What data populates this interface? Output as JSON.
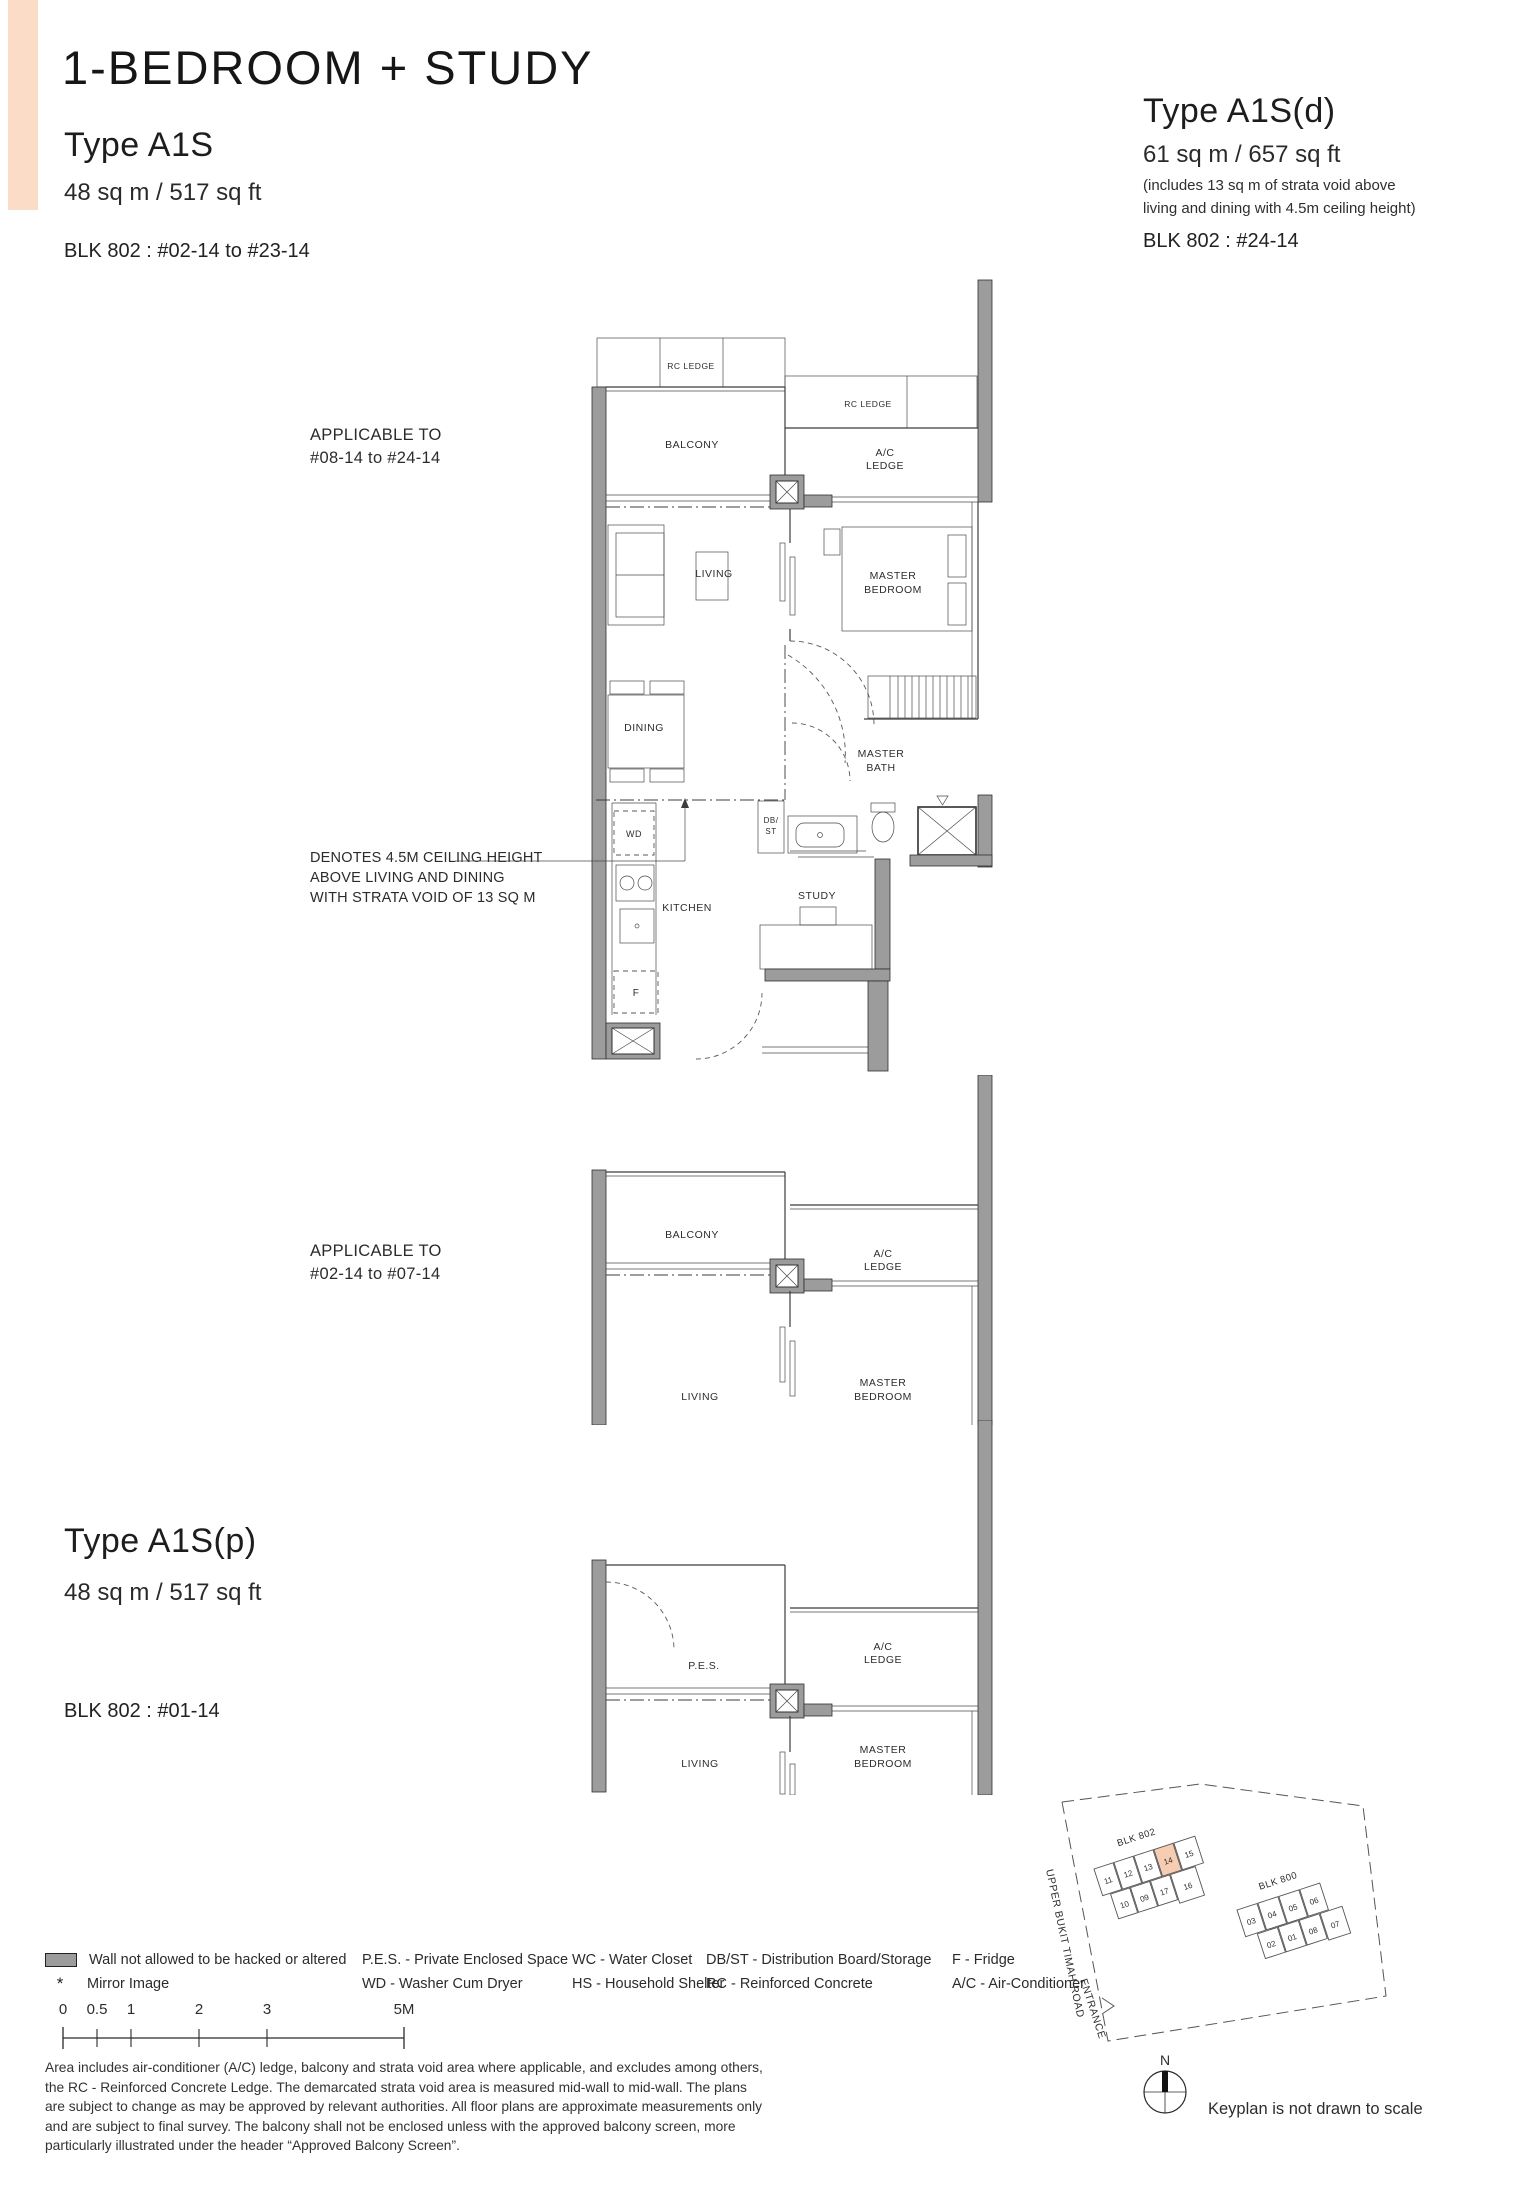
{
  "header": {
    "title": "1-BEDROOM + STUDY"
  },
  "types": {
    "a1s": {
      "name": "Type A1S",
      "area": "48 sq m / 517 sq ft",
      "block": "BLK 802 : #02-14 to #23-14"
    },
    "a1s_d": {
      "name": "Type A1S(d)",
      "area": "61 sq m / 657 sq ft",
      "area_note_line1": "(includes 13 sq m of strata void above",
      "area_note_line2": "living and dining with 4.5m ceiling height)",
      "block": "BLK 802 : #24-14"
    },
    "a1s_p": {
      "name": "Type A1S(p)",
      "area": "48 sq m / 517 sq ft",
      "block": "BLK 802 : #01-14"
    }
  },
  "plans": {
    "upper": {
      "applicable_line1": "APPLICABLE TO",
      "applicable_line2": "#08-14 to #24-14"
    },
    "lower": {
      "applicable_line1": "APPLICABLE TO",
      "applicable_line2": "#02-14 to #07-14"
    }
  },
  "rooms": {
    "rc_ledge": "RC LEDGE",
    "balcony": "BALCONY",
    "ac_line1": "A/C",
    "ac_line2": "LEDGE",
    "living": "LIVING",
    "master_line1": "MASTER",
    "master_line2": "BEDROOM",
    "dining": "DINING",
    "bath_line1": "MASTER",
    "bath_line2": "BATH",
    "db_line1": "DB/",
    "db_line2": "ST",
    "wd": "WD",
    "kitchen": "KITCHEN",
    "study": "STUDY",
    "fridge": "F",
    "pes": "P.E.S."
  },
  "void_note": {
    "line1": "DENOTES 4.5M CEILING HEIGHT",
    "line2": "ABOVE LIVING AND DINING",
    "line3": "WITH STRATA VOID OF 13 SQ M"
  },
  "legend": {
    "wall_label": "Wall not allowed to be hacked or altered",
    "mirror_marker": "*",
    "mirror_label": "Mirror Image",
    "columns": [
      [
        "P.E.S. - Private Enclosed Space",
        "WD - Washer Cum Dryer"
      ],
      [
        "WC - Water Closet",
        "HS - Household Shelter"
      ],
      [
        "DB/ST - Distribution Board/Storage",
        "RC - Reinforced Concrete"
      ],
      [
        "F - Fridge",
        "A/C - Air-Conditioner"
      ]
    ]
  },
  "scale_bar": {
    "labels": [
      "0",
      "0.5",
      "1",
      "2",
      "3",
      "5M"
    ]
  },
  "disclaimer": "Area includes air-conditioner (A/C) ledge, balcony and strata void area where applicable, and excludes among others, the RC - Reinforced Concrete Ledge. The demarcated strata void area is measured mid-wall to mid-wall. The plans are subject to change as may be approved by relevant authorities. All floor plans are approximate measurements only and are subject to final survey. The balcony shall not be enclosed unless with the approved balcony screen, more particularly illustrated under the header “Approved Balcony Screen”.",
  "keyplan": {
    "blk802": {
      "label": "BLK 802",
      "units_top": [
        "11",
        "12",
        "13",
        "14",
        "15"
      ],
      "units_bottom": [
        "10",
        "09",
        "17",
        "16"
      ],
      "highlighted_unit": "14"
    },
    "blk800": {
      "label": "BLK 800",
      "units_top": [
        "03",
        "04",
        "05",
        "06"
      ],
      "units_bottom": [
        "02",
        "01",
        "08",
        "07"
      ]
    },
    "road": "UPPER BUKIT TIMAH ROAD",
    "entrance": "ENTRANCE",
    "north": "N",
    "caption": "Keyplan is not drawn to scale"
  },
  "colors": {
    "accent_bar": "#fbdcc7",
    "keyplan_highlight": "#f6cdb2",
    "wall_gray": "#9c9c9c"
  }
}
